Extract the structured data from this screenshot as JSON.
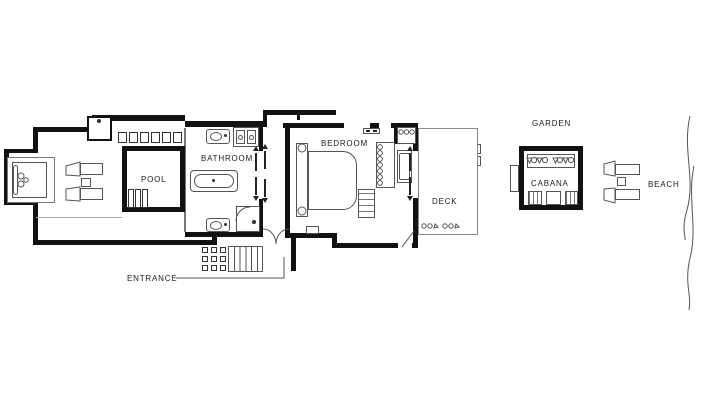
{
  "document": {
    "type": "villa-floor-plan"
  },
  "labels": {
    "pool": "POOL",
    "bathroom": "BATHROOM",
    "bedroom": "BEDROOM",
    "deck": "DECK",
    "garden": "GARDEN",
    "cabana": "CABANA",
    "beach": "BEACH",
    "entrance": "ENTRANCE"
  },
  "colors": {
    "wall": "#121212",
    "line": "#555555",
    "thin": "#8a8a8a",
    "paper": "#ffffff",
    "text": "#1c1c1c"
  }
}
